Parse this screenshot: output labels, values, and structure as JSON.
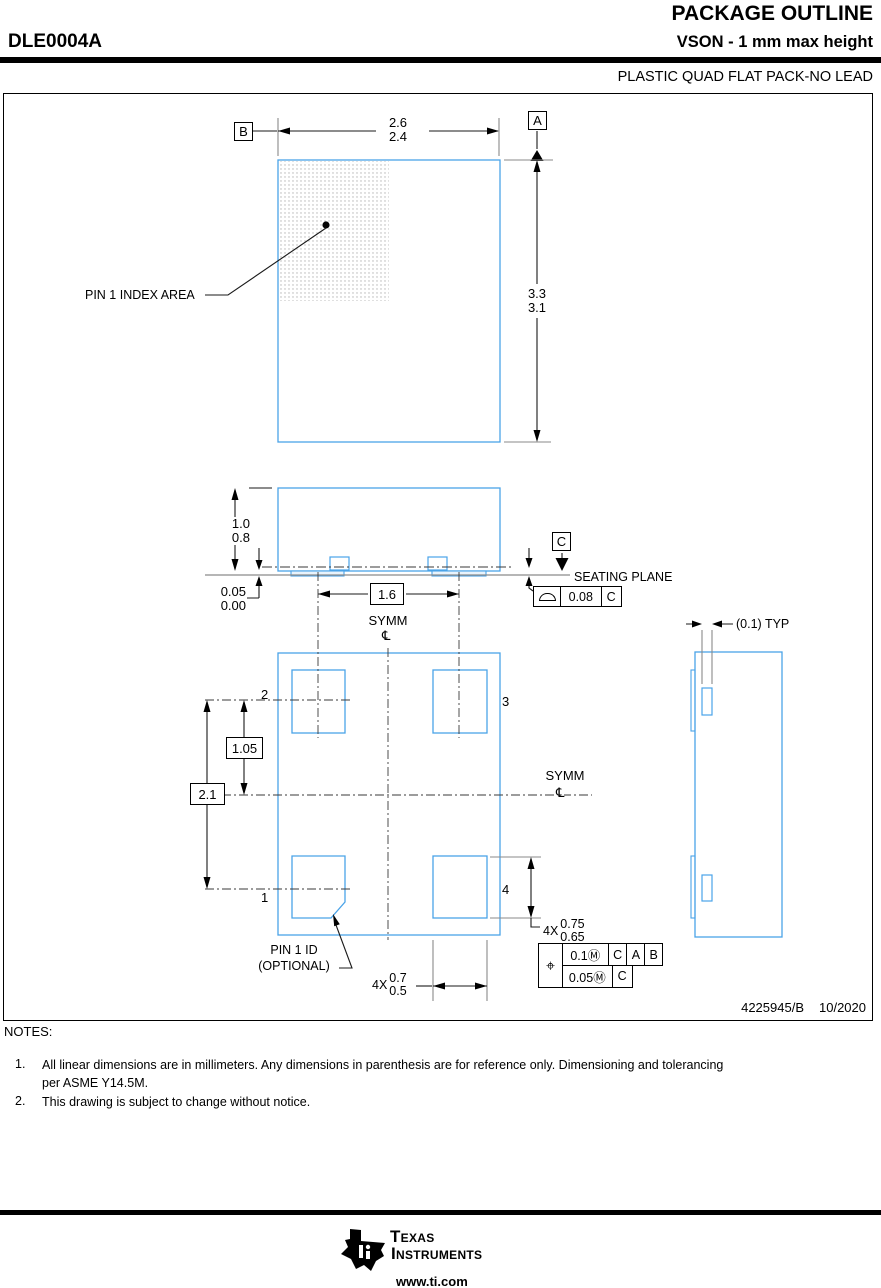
{
  "header": {
    "title": "PACKAGE OUTLINE",
    "part_number": "DLE0004A",
    "subtitle": "VSON - 1 mm max height",
    "package_type": "PLASTIC QUAD FLAT PACK-NO LEAD"
  },
  "drawing": {
    "top_view": {
      "datum_a": "A",
      "datum_b": "B",
      "width_dim": {
        "max": "2.6",
        "min": "2.4"
      },
      "height_dim": {
        "max": "3.3",
        "min": "3.1"
      },
      "pin1_index_label": "PIN 1 INDEX AREA"
    },
    "side_view": {
      "height_dim": {
        "max": "1.0",
        "min": "0.8"
      },
      "standoff_dim": {
        "max": "0.05",
        "min": "0.00"
      },
      "datum_c": "C",
      "seating_plane_label": "SEATING PLANE",
      "flatness": {
        "value": "0.08",
        "datum": "C"
      },
      "pitch_dim": "1.6",
      "symm_label": "SYMM",
      "centerline_symbol": "℄"
    },
    "bottom_view": {
      "pin_labels": {
        "p1": "1",
        "p2": "2",
        "p3": "3",
        "p4": "4"
      },
      "pad_row_dim": "1.05",
      "pad_span_dim": "2.1",
      "symm_label": "SYMM",
      "centerline_symbol": "℄",
      "pin1_id_line1": "PIN 1 ID",
      "pin1_id_line2": "(OPTIONAL)",
      "pad_length": {
        "qty": "4X",
        "max": "0.75",
        "min": "0.65"
      },
      "pad_width": {
        "qty": "4X",
        "max": "0.7",
        "min": "0.5"
      },
      "position_tol": {
        "symbol": "⌖",
        "row1": [
          "0.1Ⓜ",
          "C",
          "A",
          "B"
        ],
        "row2": [
          "0.05Ⓜ",
          "C"
        ]
      }
    },
    "detail_view": {
      "typ_dim": "(0.1) TYP"
    },
    "doc_number": "4225945/B",
    "doc_date": "10/2020"
  },
  "notes": {
    "heading": "NOTES:",
    "items": [
      {
        "num": "1.",
        "text": "All linear dimensions are in millimeters. Any dimensions in parenthesis are for reference only. Dimensioning and tolerancing\nper ASME Y14.5M."
      },
      {
        "num": "2.",
        "text": "This drawing is subject to change without notice."
      }
    ]
  },
  "footer": {
    "brand_1": "Texas",
    "brand_2": "Instruments",
    "url": "www.ti.com"
  },
  "colors": {
    "outline_blue": "#4aa3e8",
    "dim_gray": "#8a8a8a",
    "black": "#1a1a1a"
  }
}
